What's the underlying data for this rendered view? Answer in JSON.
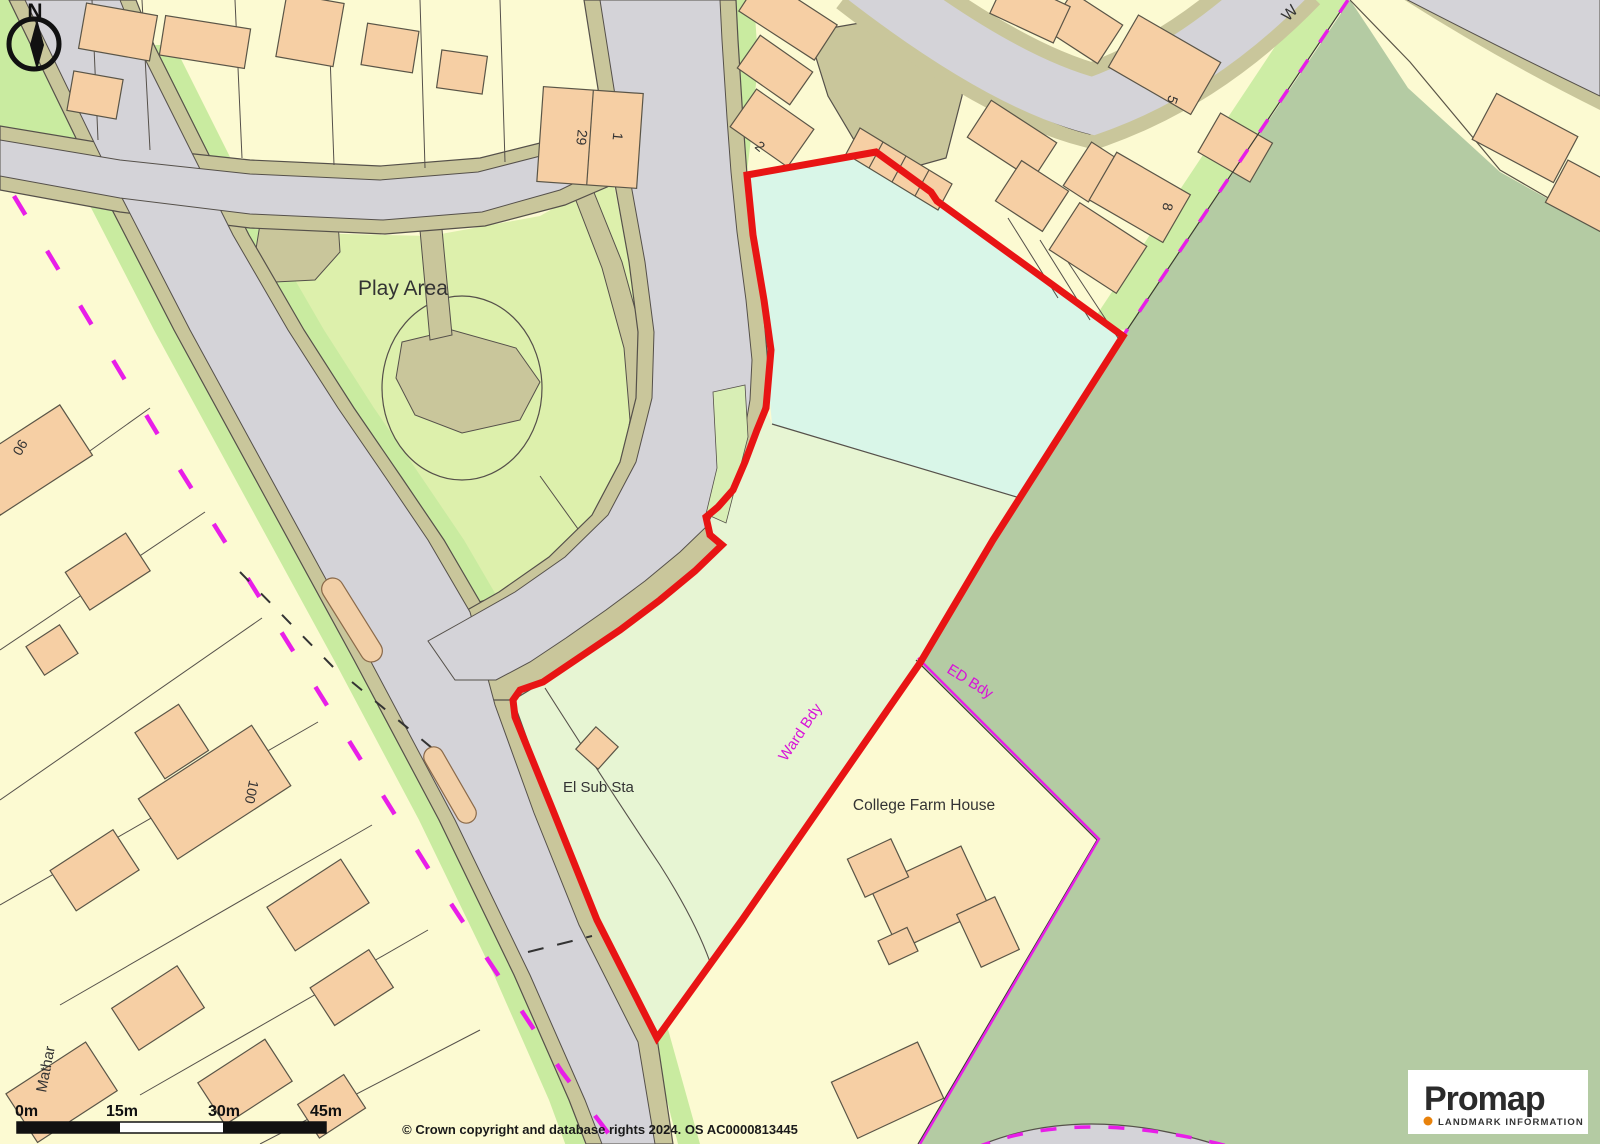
{
  "map": {
    "region_labels": {
      "play_area": "Play Area",
      "el_sub_sta": "El Sub Sta",
      "college_farm_house": "College Farm House"
    },
    "boundary_labels": {
      "ward_bdy": "Ward Bdy",
      "ed_bdy": "ED Bdy"
    },
    "street_labels": {
      "w": "W",
      "mathar": "Mathar"
    },
    "house_numbers": {
      "n29": "29",
      "n1": "1",
      "n2": "2",
      "n5": "5",
      "n8": "8",
      "n90": "90",
      "n100": "100"
    },
    "compass": {
      "north": "N"
    },
    "colors": {
      "site_boundary_red": "#e81414",
      "boundary_magenta": "#e81ee8",
      "base_yellow": "#fcfad2",
      "building_peach": "#f6cfa4",
      "road_gray": "#d4d3d8",
      "verge_olive": "#c9c69b",
      "grass_green": "#ddf0ac",
      "strip_green": "#c9eba0",
      "field_green": "#b4cba3",
      "site_mint": "#d9f6e8",
      "site_light_green": "#e7f5d3"
    }
  },
  "scale_bar": {
    "ticks": [
      "0m",
      "15m",
      "30m",
      "45m"
    ]
  },
  "attribution": {
    "text": "© Crown copyright and database rights 2024. OS AC0000813445"
  },
  "logo": {
    "brand": "Promap",
    "tagline": "LANDMARK INFORMATION",
    "dot_color": "#e8820c"
  }
}
